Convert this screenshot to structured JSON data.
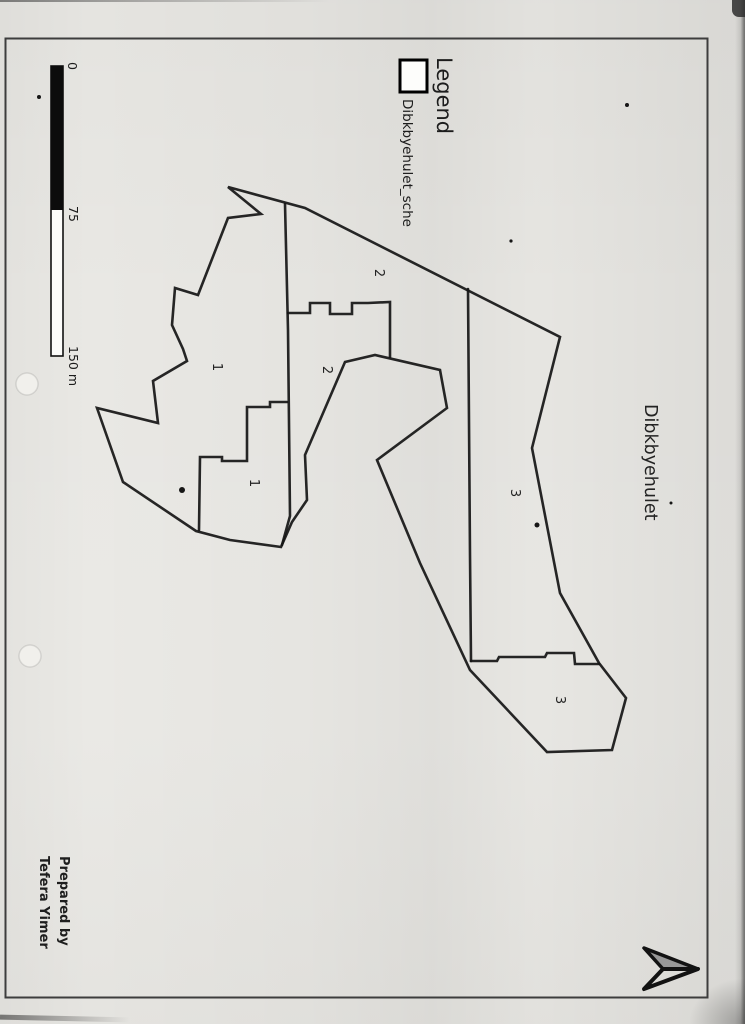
{
  "page": {
    "background": "#e9e8e4"
  },
  "map_title": {
    "text": "Dibkbyehulet"
  },
  "legend": {
    "title": "Legend",
    "items": [
      {
        "label": "Dibkbyehulet_sche",
        "swatch": "rectangle-outline",
        "swatch_fill": "#ffffff",
        "swatch_border": "#000000"
      }
    ]
  },
  "scale_bar": {
    "tick_labels": [
      "0",
      "75",
      "150 m"
    ],
    "segments": [
      {
        "from": 0,
        "to": 75,
        "fill": "#000000"
      },
      {
        "from": 75,
        "to": 150,
        "fill": "#ffffff"
      }
    ]
  },
  "credits": {
    "lines": [
      "Prepared by",
      "Tefera Yimer"
    ]
  },
  "north_arrow": {
    "points_to": "map-north (page right)",
    "fill": "#989898"
  },
  "parcel_labels": [
    {
      "text": "1",
      "x": 213,
      "y": 367
    },
    {
      "text": "1",
      "x": 250,
      "y": 483
    },
    {
      "text": "2",
      "x": 375,
      "y": 273
    },
    {
      "text": "2",
      "x": 323,
      "y": 370
    },
    {
      "text": "3",
      "x": 511,
      "y": 493
    },
    {
      "text": "3",
      "x": 556,
      "y": 700
    }
  ],
  "map_lines": {
    "stroke": "#151515",
    "stroke_width": 2.6,
    "shapes": {
      "outer_boundary": {
        "closed": true,
        "points": [
          [
            228,
            187
          ],
          [
            305,
            208
          ],
          [
            560,
            337
          ],
          [
            532,
            448
          ],
          [
            560,
            593
          ],
          [
            599,
            663
          ],
          [
            626,
            698
          ],
          [
            612,
            750
          ],
          [
            547,
            752
          ],
          [
            470,
            670
          ],
          [
            420,
            563
          ],
          [
            377,
            460
          ],
          [
            447,
            408
          ],
          [
            440,
            370
          ],
          [
            375,
            355
          ],
          [
            345,
            362
          ],
          [
            305,
            455
          ],
          [
            307,
            500
          ],
          [
            292,
            522
          ],
          [
            281,
            547
          ],
          [
            230,
            540
          ],
          [
            196,
            531
          ],
          [
            123,
            482
          ],
          [
            97,
            408
          ],
          [
            158,
            423
          ],
          [
            153,
            381
          ],
          [
            187,
            361
          ],
          [
            183,
            349
          ],
          [
            172,
            325
          ],
          [
            175,
            288
          ],
          [
            198,
            295
          ],
          [
            228,
            218
          ],
          [
            261,
            214
          ]
        ]
      },
      "divider_west": {
        "closed": false,
        "points": [
          [
            285,
            204
          ],
          [
            288,
            330
          ],
          [
            290,
            516
          ],
          [
            282,
            545
          ]
        ]
      },
      "divider_east": {
        "closed": false,
        "points": [
          [
            468,
            289
          ],
          [
            470,
            555
          ],
          [
            471,
            661
          ]
        ]
      },
      "south_step_line": {
        "closed": false,
        "points": [
          [
            471,
            661
          ],
          [
            497,
            661
          ],
          [
            499,
            657
          ],
          [
            545,
            657
          ],
          [
            547,
            653
          ],
          [
            574,
            653
          ],
          [
            575,
            664
          ],
          [
            599,
            664
          ]
        ]
      },
      "castle_step_line": {
        "closed": false,
        "points": [
          [
            288,
            313
          ],
          [
            310,
            313
          ],
          [
            310,
            303
          ],
          [
            330,
            303
          ],
          [
            330,
            314
          ],
          [
            352,
            314
          ],
          [
            352,
            303
          ],
          [
            368,
            303
          ],
          [
            390,
            302
          ],
          [
            390,
            357
          ]
        ]
      },
      "staircase_line": {
        "closed": false,
        "points": [
          [
            199,
            530
          ],
          [
            200,
            457
          ],
          [
            222,
            457
          ],
          [
            222,
            461
          ],
          [
            247,
            461
          ],
          [
            247,
            407
          ],
          [
            270,
            407
          ],
          [
            270,
            402
          ],
          [
            287,
            402
          ]
        ]
      }
    }
  },
  "map_dots": [
    [
      182,
      490,
      3
    ],
    [
      537,
      525,
      2.5
    ],
    [
      627,
      105,
      2
    ],
    [
      39,
      97,
      2
    ],
    [
      511,
      241,
      1.6
    ],
    [
      671,
      503,
      1.5
    ]
  ],
  "punch_holes": [
    [
      27,
      384,
      11
    ],
    [
      30,
      656,
      11
    ]
  ]
}
